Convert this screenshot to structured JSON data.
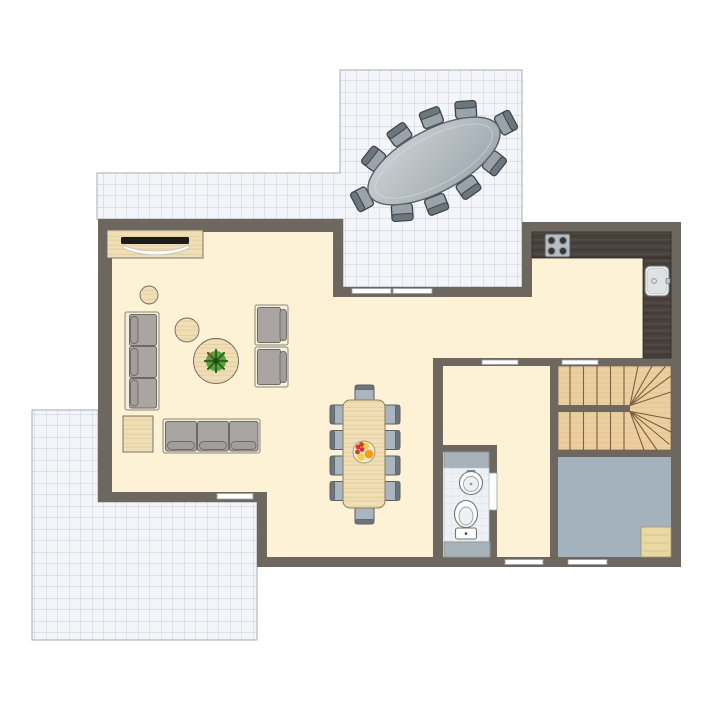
{
  "palette": {
    "white": "#ffffff",
    "wall": "#6e6760",
    "floor": "#fdf2d6",
    "terrace_tile": "#f3f5f8",
    "terrace_grid": "#c6cdd7",
    "wood_light": "#efdeb6",
    "wood_dark": "#49423c",
    "stair_wood": "#eccfa1",
    "stair_line": "#7d5f3f",
    "gray_room_floor": "#a4b2bd",
    "bath_tile": "#eef2f6",
    "cabinet_gray": "#a9b2b9",
    "sofa_frame": "#f4eedd",
    "sofa_cushion": "#a9a5a2",
    "chair_blue": "#a9b6bf",
    "chair_blue_back": "#6d747b",
    "outdoor_chair_seat": "#9aa3aa",
    "outdoor_chair_back": "#6e767d",
    "table_gray_light": "#cdd4d8",
    "table_gray_dark": "#9ba5ac",
    "plant_green": "#5ca23d",
    "fruit_red": "#cf3a30",
    "fruit_orange": "#f49c1c",
    "fruit_yellow": "#f5cf3d"
  },
  "plan": {
    "type": "floor-plan",
    "rooms": [
      {
        "id": "upper-terrace",
        "flooring": "tile-grid",
        "items": [
          {
            "name": "outdoor-oval-dining-table",
            "seats": 10
          }
        ]
      },
      {
        "id": "living-dining-room",
        "flooring": "cream",
        "items": [
          {
            "name": "tv-sideboard"
          },
          {
            "name": "tv"
          },
          {
            "name": "sofa-3-seat",
            "count": 2
          },
          {
            "name": "armchair",
            "count": 2
          },
          {
            "name": "round-pouf",
            "count": 2
          },
          {
            "name": "square-pouf"
          },
          {
            "name": "round-coffee-table"
          },
          {
            "name": "potted-plant"
          },
          {
            "name": "dining-table",
            "seats": 10
          },
          {
            "name": "fruit-bowl"
          }
        ]
      },
      {
        "id": "kitchen",
        "items": [
          {
            "name": "l-shaped-counter"
          },
          {
            "name": "cooktop-4-burner"
          },
          {
            "name": "kitchen-sink"
          }
        ]
      },
      {
        "id": "hallway",
        "items": []
      },
      {
        "id": "bathroom",
        "flooring": "tile-grid",
        "items": [
          {
            "name": "washbasin"
          },
          {
            "name": "toilet"
          },
          {
            "name": "cabinet",
            "count": 2
          }
        ]
      },
      {
        "id": "staircase",
        "items": [
          {
            "name": "u-shaped-winder-stair",
            "flights": 2
          }
        ]
      },
      {
        "id": "utility-room",
        "flooring": "gray",
        "items": [
          {
            "name": "floor-mat"
          }
        ]
      },
      {
        "id": "lower-terrace",
        "flooring": "tile-grid",
        "items": []
      }
    ],
    "openings": {
      "sliding_door_panels": 2,
      "interior_door_openings": 3,
      "windows": 3
    }
  }
}
